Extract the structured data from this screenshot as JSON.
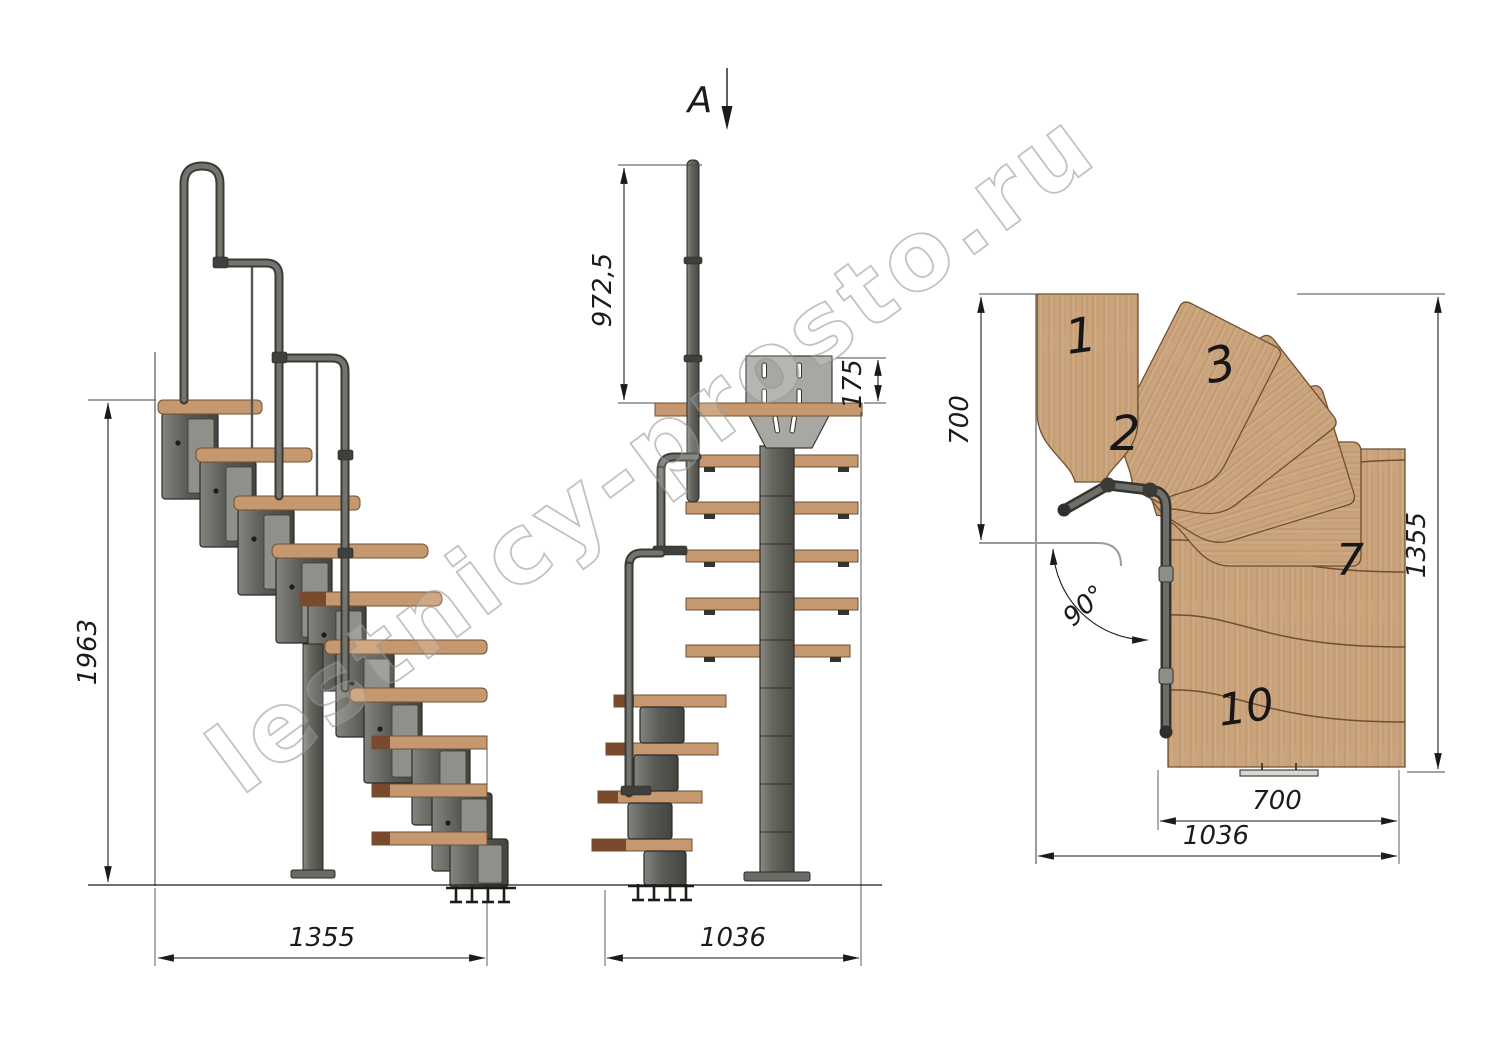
{
  "watermark": {
    "text": "lestnicy-prosto.ru"
  },
  "section": {
    "label": "A"
  },
  "dimensions": {
    "side_height": "1963",
    "side_width": "1355",
    "front_rail_height": "972,5",
    "front_plate_height": "175",
    "front_width": "1036",
    "plan_depth": "700",
    "plan_height": "1355",
    "plan_flight_width": "700",
    "plan_width": "1036",
    "plan_angle": "90°"
  },
  "plan_treads": {
    "t1": "1",
    "t2": "2",
    "t3": "3",
    "t7": "7",
    "t10": "10"
  },
  "colors": {
    "wood": "#cba47c",
    "wood_edge": "#6f4f30",
    "metal": "#5d5d58",
    "metal_light": "#a3a39e",
    "line": "#1b1b1b",
    "watermark": "#9b9b9b"
  }
}
